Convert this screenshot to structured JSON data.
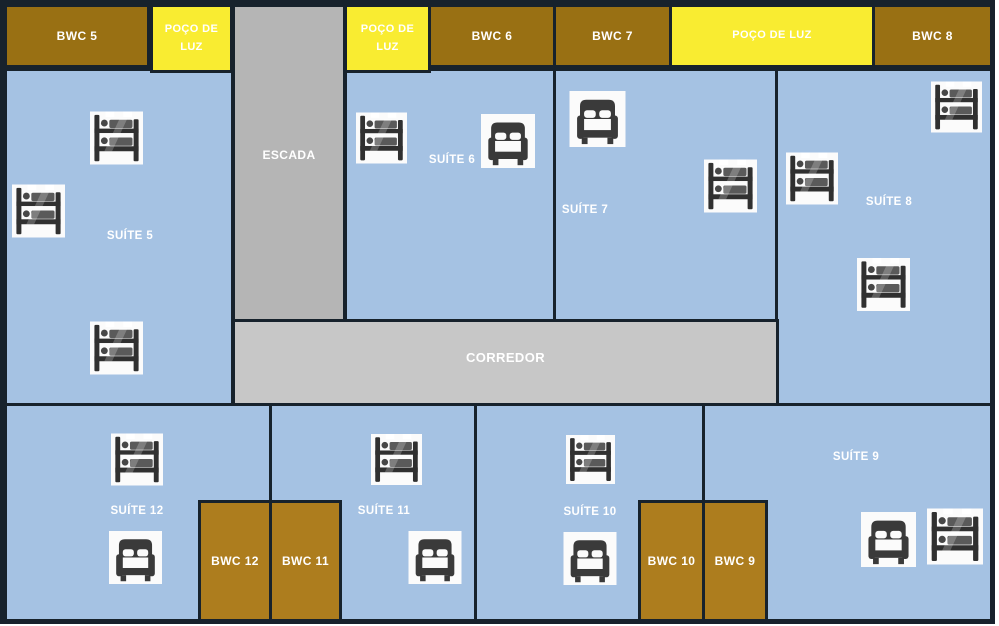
{
  "title": "Floor plan with suites, bathrooms and light wells",
  "rooms": {
    "bwc5": {
      "label": "BWC 5"
    },
    "poco_luz_a": {
      "label": "POÇO DE LUZ"
    },
    "escada": {
      "label": "ESCADA"
    },
    "poco_luz_b": {
      "label": "POÇO DE LUZ"
    },
    "bwc6": {
      "label": "BWC 6"
    },
    "bwc7": {
      "label": "BWC 7"
    },
    "poco_luz_c": {
      "label": "POÇO DE LUZ"
    },
    "bwc8": {
      "label": "BWC 8"
    },
    "suite5": {
      "label": "SUÍTE 5"
    },
    "suite6": {
      "label": "SUÍTE 6"
    },
    "suite7": {
      "label": "SUÍTE 7"
    },
    "suite8": {
      "label": "SUÍTE 8"
    },
    "corredor": {
      "label": "CORREDOR"
    },
    "suite9": {
      "label": "SUÍTE 9"
    },
    "suite10": {
      "label": "SUÍTE 10"
    },
    "suite11": {
      "label": "SUÍTE 11"
    },
    "suite12": {
      "label": "SUÍTE 12"
    },
    "bwc12": {
      "label": "BWC 12"
    },
    "bwc11": {
      "label": "BWC 11"
    },
    "bwc10": {
      "label": "BWC 10"
    },
    "bwc9": {
      "label": "BWC 9"
    }
  },
  "icons": {
    "bunk_bed": "bunk-bed-icon",
    "double_bed": "double-bed-icon"
  },
  "bed_counts": {
    "bunk_beds": 12,
    "double_beds": 6
  },
  "colors": {
    "suite_fill": "#a5c2e3",
    "bwc_top_fill": "#997013",
    "bwc_bottom_fill": "#ad7d1e",
    "light_well_fill": "#f9ec31",
    "stair_fill": "#b5b5b5",
    "corridor_fill": "#c7c7c7",
    "outline": "#17222c",
    "label_text": "#ffffff"
  }
}
